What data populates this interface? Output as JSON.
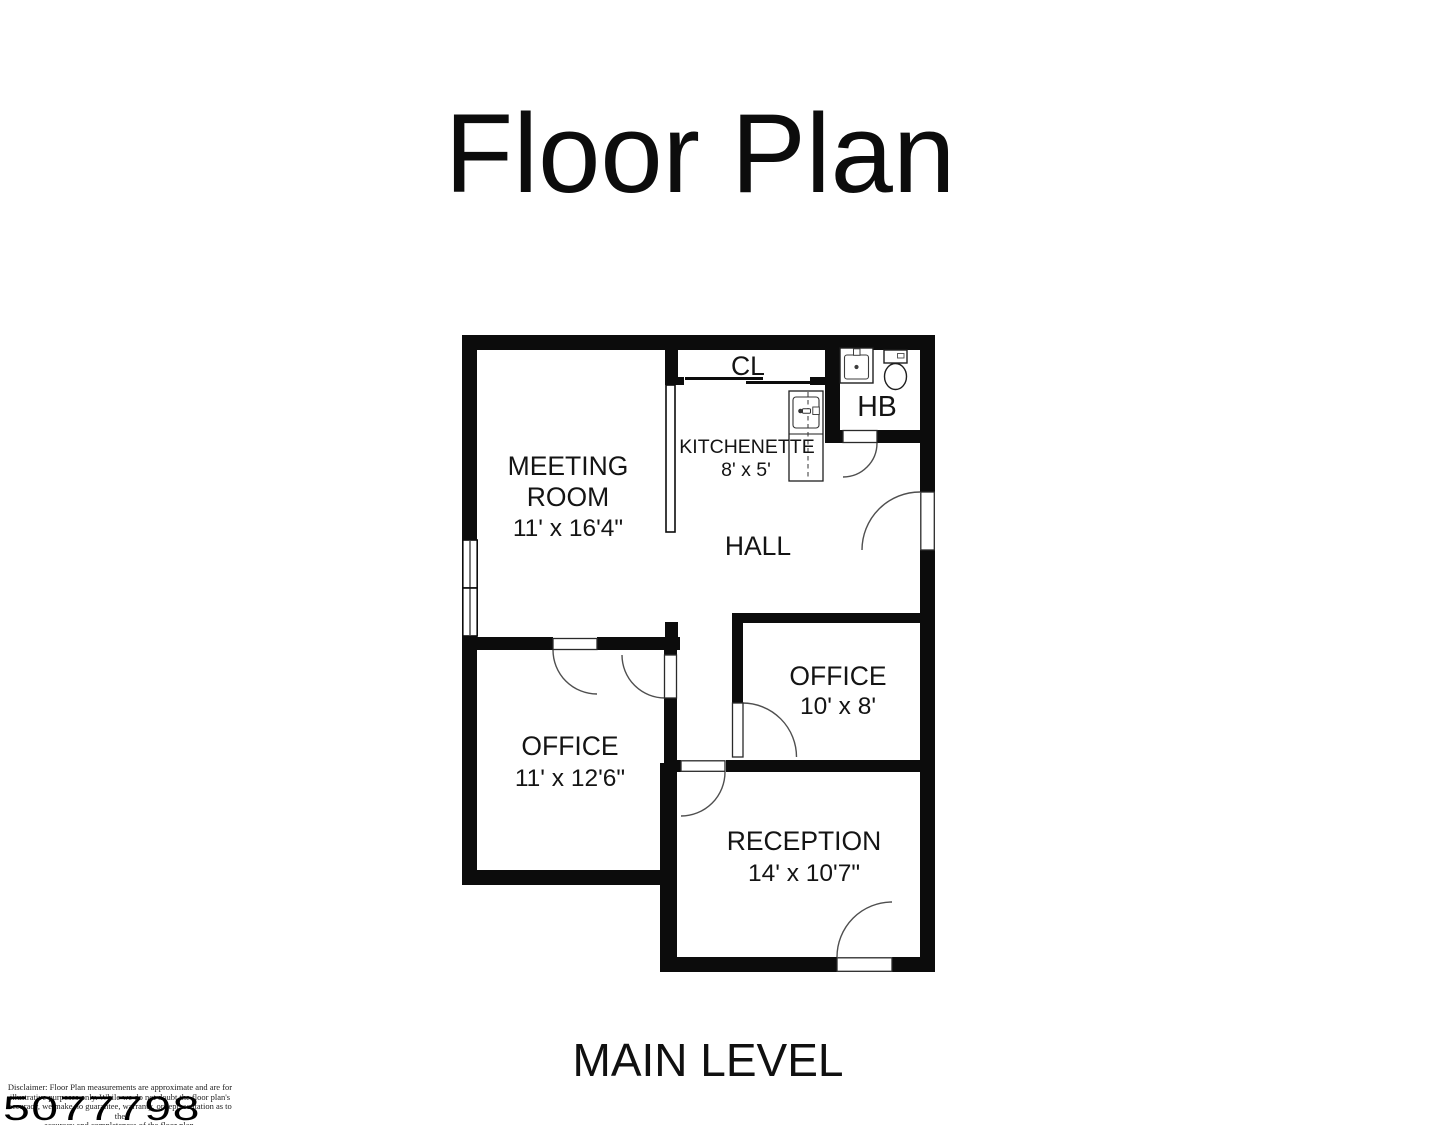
{
  "title": "Floor Plan",
  "level_label": "MAIN LEVEL",
  "listing_number": "5077798",
  "disclaimer": {
    "line1": "Disclaimer: Floor Plan measurements are approximate and are for",
    "line2": "illustrative purposes only. While we do not doubt the floor plan's",
    "line3": "accuracy, we make no guarantee, warranty, or representation as to the",
    "line4": "accuracy and completeness of the floor plan."
  },
  "rooms": {
    "meeting_room": {
      "name_line1": "MEETING",
      "name_line2": "ROOM",
      "dimensions": "11' x 16'4\""
    },
    "closet": {
      "name": "CL"
    },
    "kitchenette": {
      "name": "KITCHENETTE",
      "dimensions": "8' x 5'"
    },
    "half_bath": {
      "name": "HB"
    },
    "hall": {
      "name": "HALL"
    },
    "office_upper": {
      "name": "OFFICE",
      "dimensions": "10' x 8'"
    },
    "office_lower": {
      "name": "OFFICE",
      "dimensions": "11' x 12'6\""
    },
    "reception": {
      "name": "RECEPTION",
      "dimensions": "14' x 10'7\""
    }
  },
  "fixtures": {
    "half_bath": [
      "bathroom-sink",
      "toilet"
    ],
    "kitchenette": [
      "kitchen-sink-counter"
    ]
  },
  "colors": {
    "wall": "#0c0c0c",
    "background": "#ffffff",
    "door_arc": "#4f4f4f"
  }
}
